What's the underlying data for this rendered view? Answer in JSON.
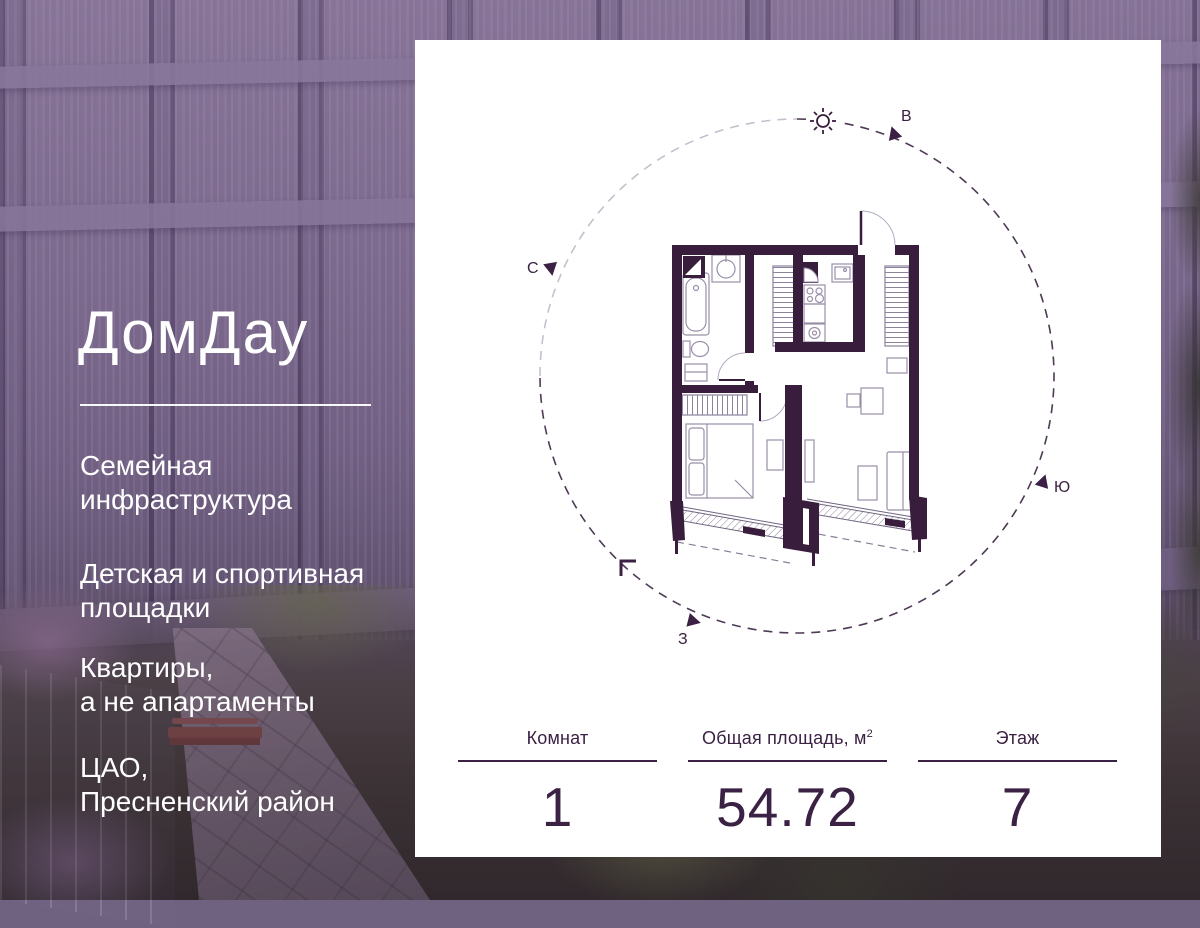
{
  "brand": {
    "logo": "ДомДау"
  },
  "left_panel": {
    "features": [
      "Семейная\nинфраструктура",
      "Детская и спортивная\nплощадки",
      "Квартиры,\nа не апартаменты",
      "ЦАО,\nПресненский район"
    ]
  },
  "card": {
    "compass": {
      "north": "С",
      "east": "В",
      "south": "Ю",
      "west": "З"
    },
    "stats": [
      {
        "label": "Комнат",
        "sup": "",
        "value": "1"
      },
      {
        "label": "Общая площадь, м",
        "sup": "2",
        "value": "54.72"
      },
      {
        "label": "Этаж",
        "sup": "",
        "value": "7"
      }
    ]
  },
  "colors": {
    "accent": "#3B2143",
    "wall": "#391D3C",
    "card_bg": "#FFFFFF",
    "text_on_photo": "#FFFFFF"
  }
}
